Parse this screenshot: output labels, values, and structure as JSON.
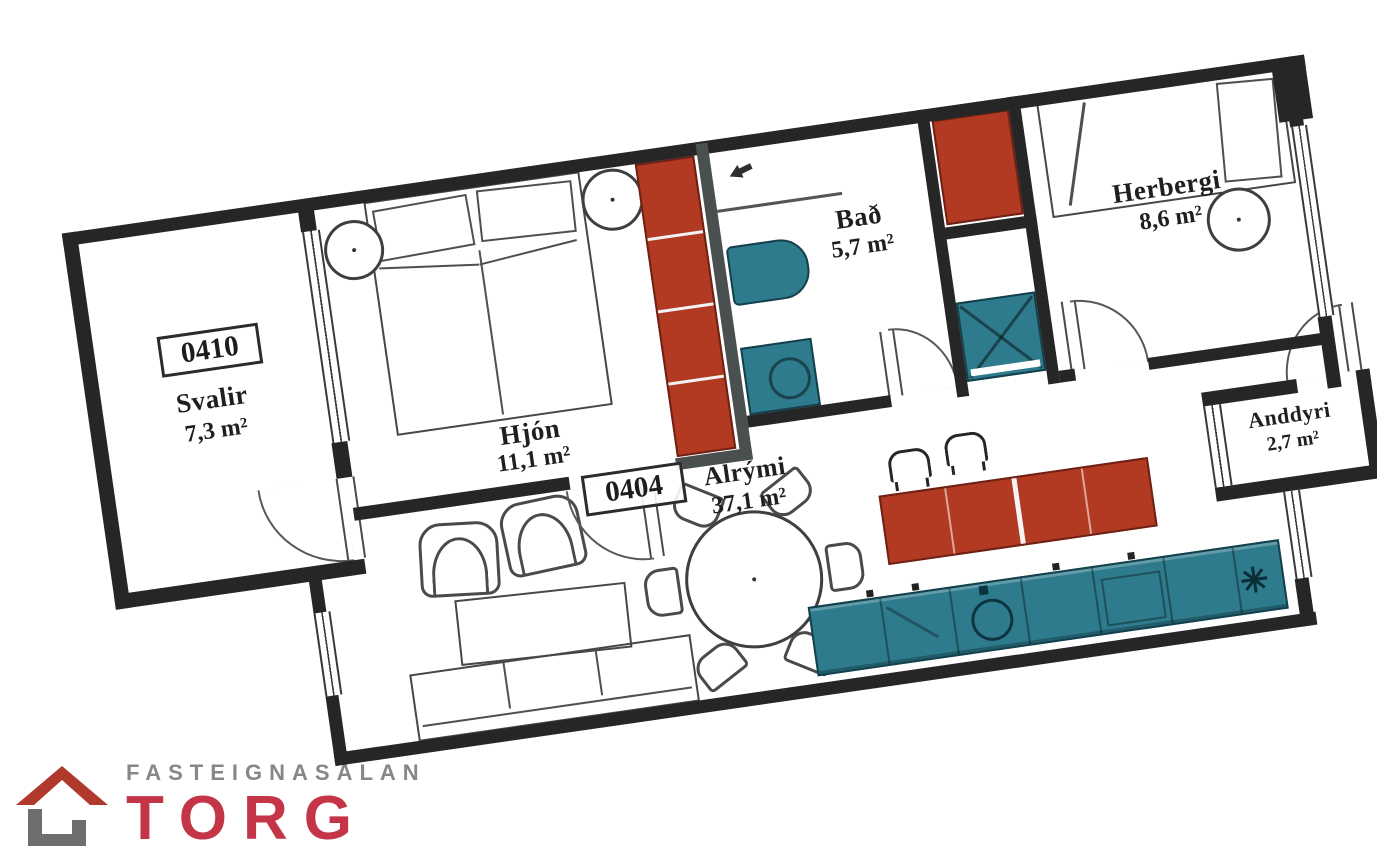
{
  "plan": {
    "units": {
      "balcony": "0410",
      "apartment": "0404"
    },
    "rooms": {
      "svalir": {
        "name": "Svalir",
        "area": "7,3 m²"
      },
      "hjon": {
        "name": "Hjón",
        "area": "11,1 m²"
      },
      "bad": {
        "name": "Bað",
        "area": "5,7 m²"
      },
      "herbergi": {
        "name": "Herbergi",
        "area": "8,6 m²"
      },
      "anddyri": {
        "name": "Anddyri",
        "area": "2,7 m²"
      },
      "alrymi": {
        "name": "Alrými",
        "area": "37,1 m²"
      }
    },
    "colors": {
      "wall": "#262626",
      "fixture_red": "#b23a23",
      "fixture_teal": "#2e7b8d",
      "furniture_line": "#4a4a4a"
    },
    "icons": {
      "bath_vent": "arrow-left-icon",
      "freezer": "star-icon",
      "shower": "x-cross-icon"
    }
  },
  "logo": {
    "tagline": "FASTEIGNASALAN",
    "brand": "TORG",
    "tagline_color": "#878787",
    "brand_color": "#c43547",
    "roof_color": "#b0392b",
    "base_color": "#6e6e6e"
  }
}
